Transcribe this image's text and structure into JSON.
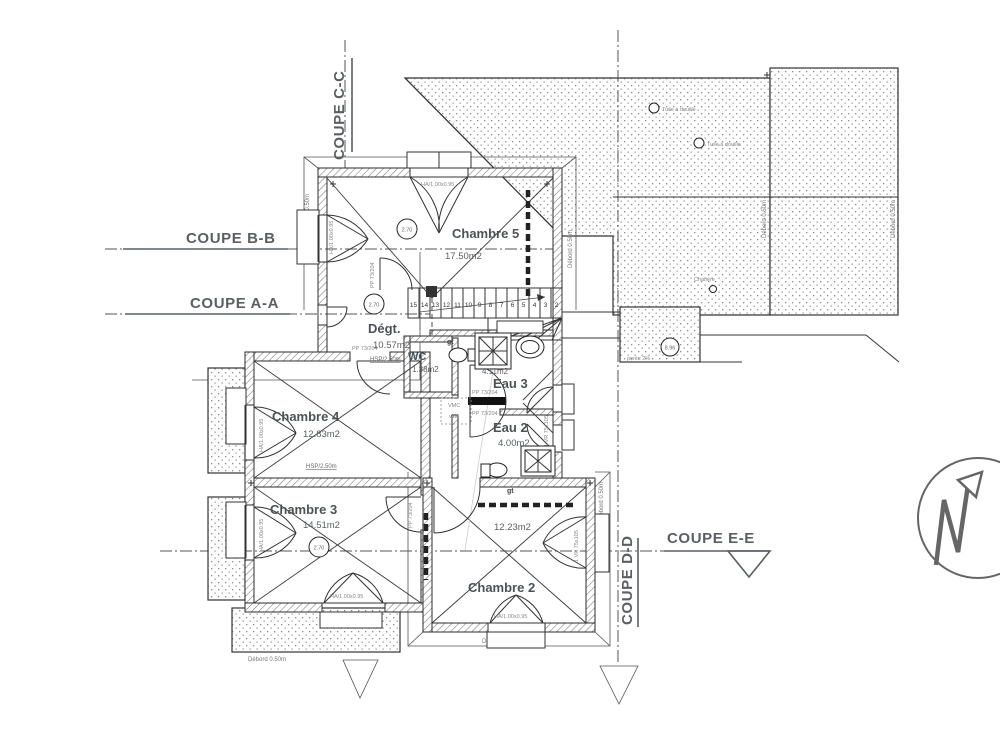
{
  "coupes": {
    "bb": "COUPE B-B",
    "aa": "COUPE A-A",
    "cc": "COUPE C-C",
    "dd": "COUPE D-D",
    "ee": "COUPE E-E"
  },
  "rooms": {
    "chambre5": {
      "name": "Chambre 5",
      "area": "17.50m2"
    },
    "chambre4": {
      "name": "Chambre 4",
      "area": "12.83m2",
      "hsp": "HSP/2.50m"
    },
    "chambre3": {
      "name": "Chambre 3",
      "area": "14.51m2"
    },
    "chambre2": {
      "name": "Chambre 2",
      "area": "12.23m2"
    },
    "degt": {
      "name": "Dégt.",
      "area": "10.57m2",
      "hsp": "HSP/2.50m"
    },
    "wc": {
      "name": "WC",
      "area": "1.38m2"
    },
    "eau3": {
      "name": "Eau 3",
      "area": "4.11m2"
    },
    "eau2": {
      "name": "Eau 2",
      "area": "4.00m2"
    }
  },
  "stairs": {
    "numbers": [
      "15",
      "14",
      "13",
      "12",
      "11",
      "10",
      "9",
      "8",
      "7",
      "6",
      "5",
      "4",
      "3",
      "2"
    ]
  },
  "annotations": {
    "ceiling_height": "2.70",
    "roof_level": "8.96",
    "slope": "pente 2%",
    "vmc": "VMC",
    "vide": "vide",
    "gutter": "gt",
    "overhang": "Débord 0.50m",
    "window_ha": "HA/1.00x0.95",
    "window_vr": "1 VR 75x105",
    "door_pp": "PP 73/204",
    "roof_vent": "Tuile à douille",
    "roof_vent_small": "Chatière"
  }
}
